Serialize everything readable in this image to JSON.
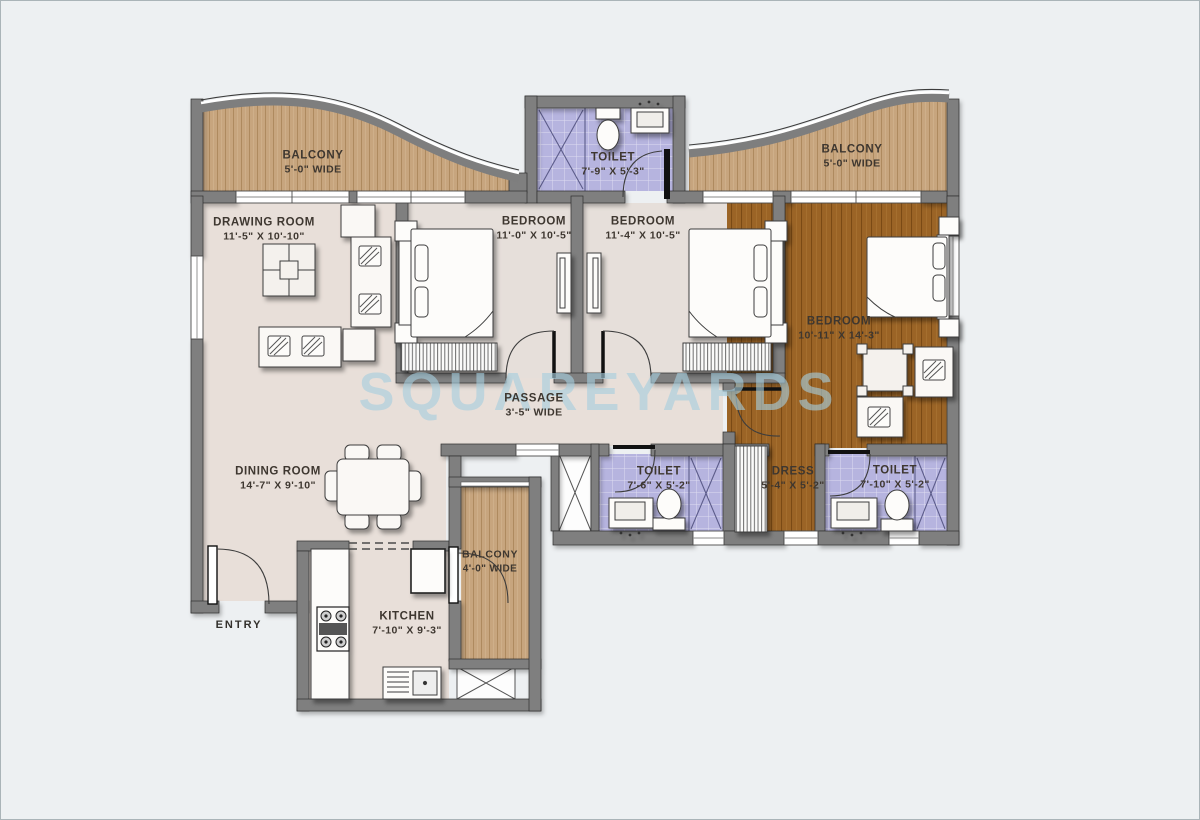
{
  "watermark": {
    "text": "SQUAREYARDS"
  },
  "labels": {
    "entry": "ENTRY"
  },
  "rooms": {
    "balcony_top_left": {
      "name": "BALCONY",
      "dims": "5'-0\" WIDE"
    },
    "toilet_top": {
      "name": "TOILET",
      "dims": "7'-9\" X 5'-3\""
    },
    "balcony_top_right": {
      "name": "BALCONY",
      "dims": "5'-0\" WIDE"
    },
    "drawing_room": {
      "name": "DRAWING ROOM",
      "dims": "11'-5\" X 10'-10\""
    },
    "bedroom_1": {
      "name": "BEDROOM",
      "dims": "11'-0\" X 10'-5\""
    },
    "bedroom_2": {
      "name": "BEDROOM",
      "dims": "11'-4\" X 10'-5\""
    },
    "master_bedroom": {
      "name": "BEDROOM",
      "dims": "10'-11\" X 14'-3\""
    },
    "passage": {
      "name": "PASSAGE",
      "dims": "3'-5\" WIDE"
    },
    "dining_room": {
      "name": "DINING ROOM",
      "dims": "14'-7\" X 9'-10\""
    },
    "toilet_mid": {
      "name": "TOILET",
      "dims": "7'-6\" X 5'-2\""
    },
    "dress": {
      "name": "DRESS",
      "dims": "5'-4\" X 5'-2\""
    },
    "toilet_right": {
      "name": "TOILET",
      "dims": "7'-10\" X 5'-2\""
    },
    "balcony_kitchen": {
      "name": "BALCONY",
      "dims": "4'-0\" WIDE"
    },
    "kitchen": {
      "name": "KITCHEN",
      "dims": "7'-10\" X 9'-3\""
    }
  },
  "colors": {
    "background": "#edf0f2",
    "wall": "#7f7f7f",
    "floor_beige": "#e8dfd9",
    "balcony_wood": "#c7a57e",
    "master_wood": "#9b6426",
    "toilet_tile": "#b6b4df",
    "watermark": "#a6cede"
  }
}
